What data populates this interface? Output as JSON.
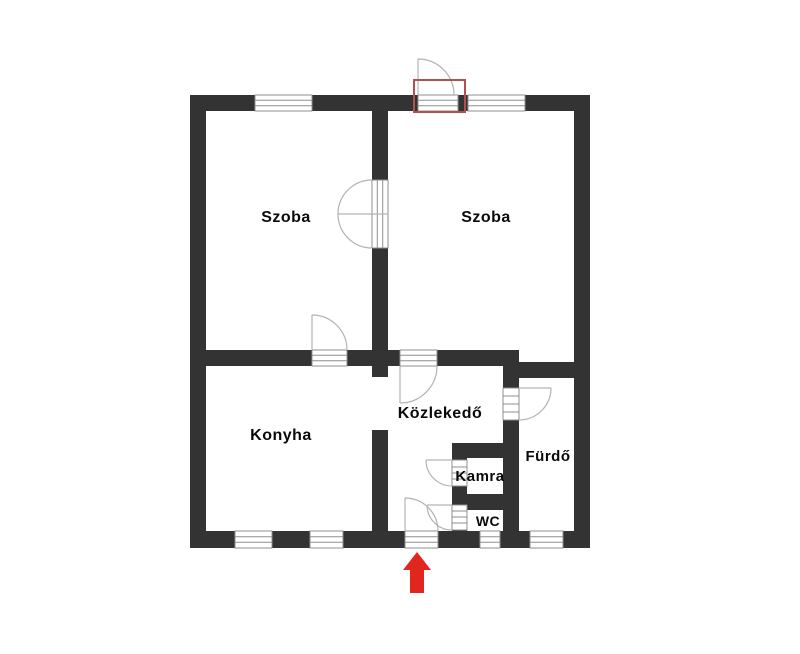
{
  "colors": {
    "background": "#ffffff",
    "wall": "#333333",
    "opening_outline": "#8f8f8f",
    "door_swing": "#b3b3b3",
    "label_text": "#0a0a0a",
    "door_marker_red": "#b0514e",
    "arrow_red": "#e1261d"
  },
  "rooms": [
    {
      "id": "szoba-1",
      "label": "Szoba"
    },
    {
      "id": "szoba-2",
      "label": "Szoba"
    },
    {
      "id": "konyha",
      "label": "Konyha"
    },
    {
      "id": "kozlekedo",
      "label": "Közlekedő"
    },
    {
      "id": "kamra",
      "label": "Kamra"
    },
    {
      "id": "furdo",
      "label": "Fürdő"
    },
    {
      "id": "wc",
      "label": "WC"
    }
  ]
}
